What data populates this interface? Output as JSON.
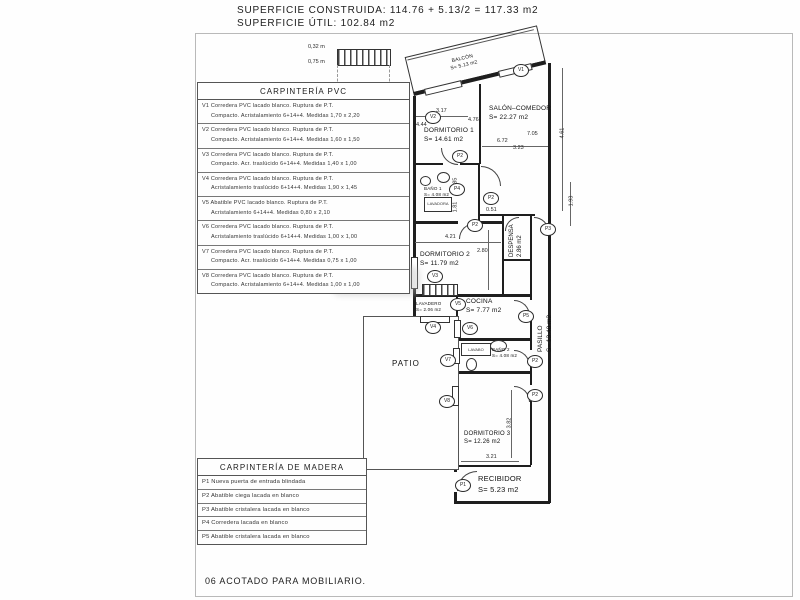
{
  "header": {
    "line1": "SUPERFICIE CONSTRUIDA: 114.76 + 5.13/2 = 117.33 m2",
    "line2": "SUPERFICIE ÚTIL: 102.84 m2"
  },
  "footer": {
    "note": "06 ACOTADO PARA MOBILIARIO."
  },
  "pvc_table": {
    "title": "CARPINTERÍA PVC",
    "rows": [
      {
        "line1": "V1 Corredera PVC lacado blanco. Ruptura de P.T.",
        "line2": "Compacto. Acristalamiento 6+14+4. Medidas 1,70 x 2,20"
      },
      {
        "line1": "V2 Corredera PVC lacado blanco. Ruptura de P.T.",
        "line2": "Compacto. Acristalamiento 6+14+4. Medidas 1,60 x 1,50"
      },
      {
        "line1": "V3 Corredera PVC lacado blanco. Ruptura de P.T.",
        "line2": "Compacto. Acr. traslúcido 6+14+4. Medidas 1,40 x 1,00"
      },
      {
        "line1": "V4 Corredera PVC lacado blanco. Ruptura de P.T.",
        "line2": "Acristalamiento traslúcido 6+14+4. Medidas 1,90 x 1,45"
      },
      {
        "line1": "V5 Abatible PVC lacado blanco. Ruptura de P.T.",
        "line2": "Acristalamiento 6+14+4. Medidas 0,80 x 2,10"
      },
      {
        "line1": "V6 Corredera PVC lacado blanco. Ruptura de P.T.",
        "line2": "Acristalamiento traslúcido 6+14+4. Medidas 1,00 x 1,00"
      },
      {
        "line1": "V7 Corredera PVC lacado blanco. Ruptura de P.T.",
        "line2": "Compacto. Acr. traslúcido 6+14+4. Medidas 0,75 x 1,00"
      },
      {
        "line1": "V8 Corredera PVC lacado blanco. Ruptura de P.T.",
        "line2": "Compacto. Acristalamiento 6+14+4. Medidas 1,00 x 1,00"
      }
    ]
  },
  "madera_table": {
    "title": "CARPINTERÍA DE MADERA",
    "rows": [
      "P1 Nueva puerta de entrada blindada",
      "P2 Abatible ciega lacada en blanco",
      "P3 Abatible cristalera lacada en blanco",
      "P4 Corredera lacada en blanco",
      "P5 Abatible cristalera lacada en blanco"
    ]
  },
  "plan": {
    "rooms": {
      "balcon": {
        "name": "BALCÓN",
        "area": "S= 5.13 m2"
      },
      "salon": {
        "name": "SALÓN–COMEDOR",
        "area": "S= 22.27 m2"
      },
      "dorm1": {
        "name": "DORMITORIO 1",
        "area": "S= 14.61 m2"
      },
      "bano1": {
        "name": "BAÑO 1",
        "area": "S= 4.08 m2"
      },
      "despensa": {
        "name": "DESPENSA",
        "area": "2.86 m2"
      },
      "dorm2": {
        "name": "DORMITORIO 2",
        "area": "S= 11.79 m2"
      },
      "cocina": {
        "name": "COCINA",
        "area": "S= 7.77 m2"
      },
      "lavadero": {
        "name": "LAVADERO",
        "area": "S= 2.06 m2"
      },
      "pasillo": {
        "name": "PASILLO",
        "area": "S= 13.40 m2"
      },
      "patio": {
        "name": "PATIO"
      },
      "bano2": {
        "name": "BAÑO 2",
        "area": "S= 4.08 m2"
      },
      "dorm3": {
        "name": "DORMITORIO 3",
        "area": "S= 12.26 m2"
      },
      "recibidor": {
        "name": "RECIBIDOR",
        "area": "S= 5.23 m2"
      }
    },
    "refs": {
      "v1": "V1",
      "v2": "V2",
      "v3": "V3",
      "v4": "V4",
      "v5": "V5",
      "v6": "V6",
      "v7": "V7",
      "v8": "V8",
      "p1": "P1",
      "p2": "P2",
      "p3": "P3",
      "p4": "P4",
      "p5": "P5"
    },
    "dims": {
      "d317": "3.17",
      "d476": "4.76",
      "d444": "4.44",
      "d461": "4.61",
      "d672": "6.72",
      "d705": "7.05",
      "d323": "3.23",
      "d193": "1.93",
      "d051": "0.51",
      "d421": "4.21",
      "d280": "2.80",
      "d185": "1.85",
      "d181": "1.81",
      "d382": "3.82",
      "d321": "3.21",
      "d032": "0,32 m",
      "d075": "0,75 m"
    },
    "fixtures": {
      "lavadora": "LAVADORA",
      "lavabo": "LAVABO"
    }
  }
}
